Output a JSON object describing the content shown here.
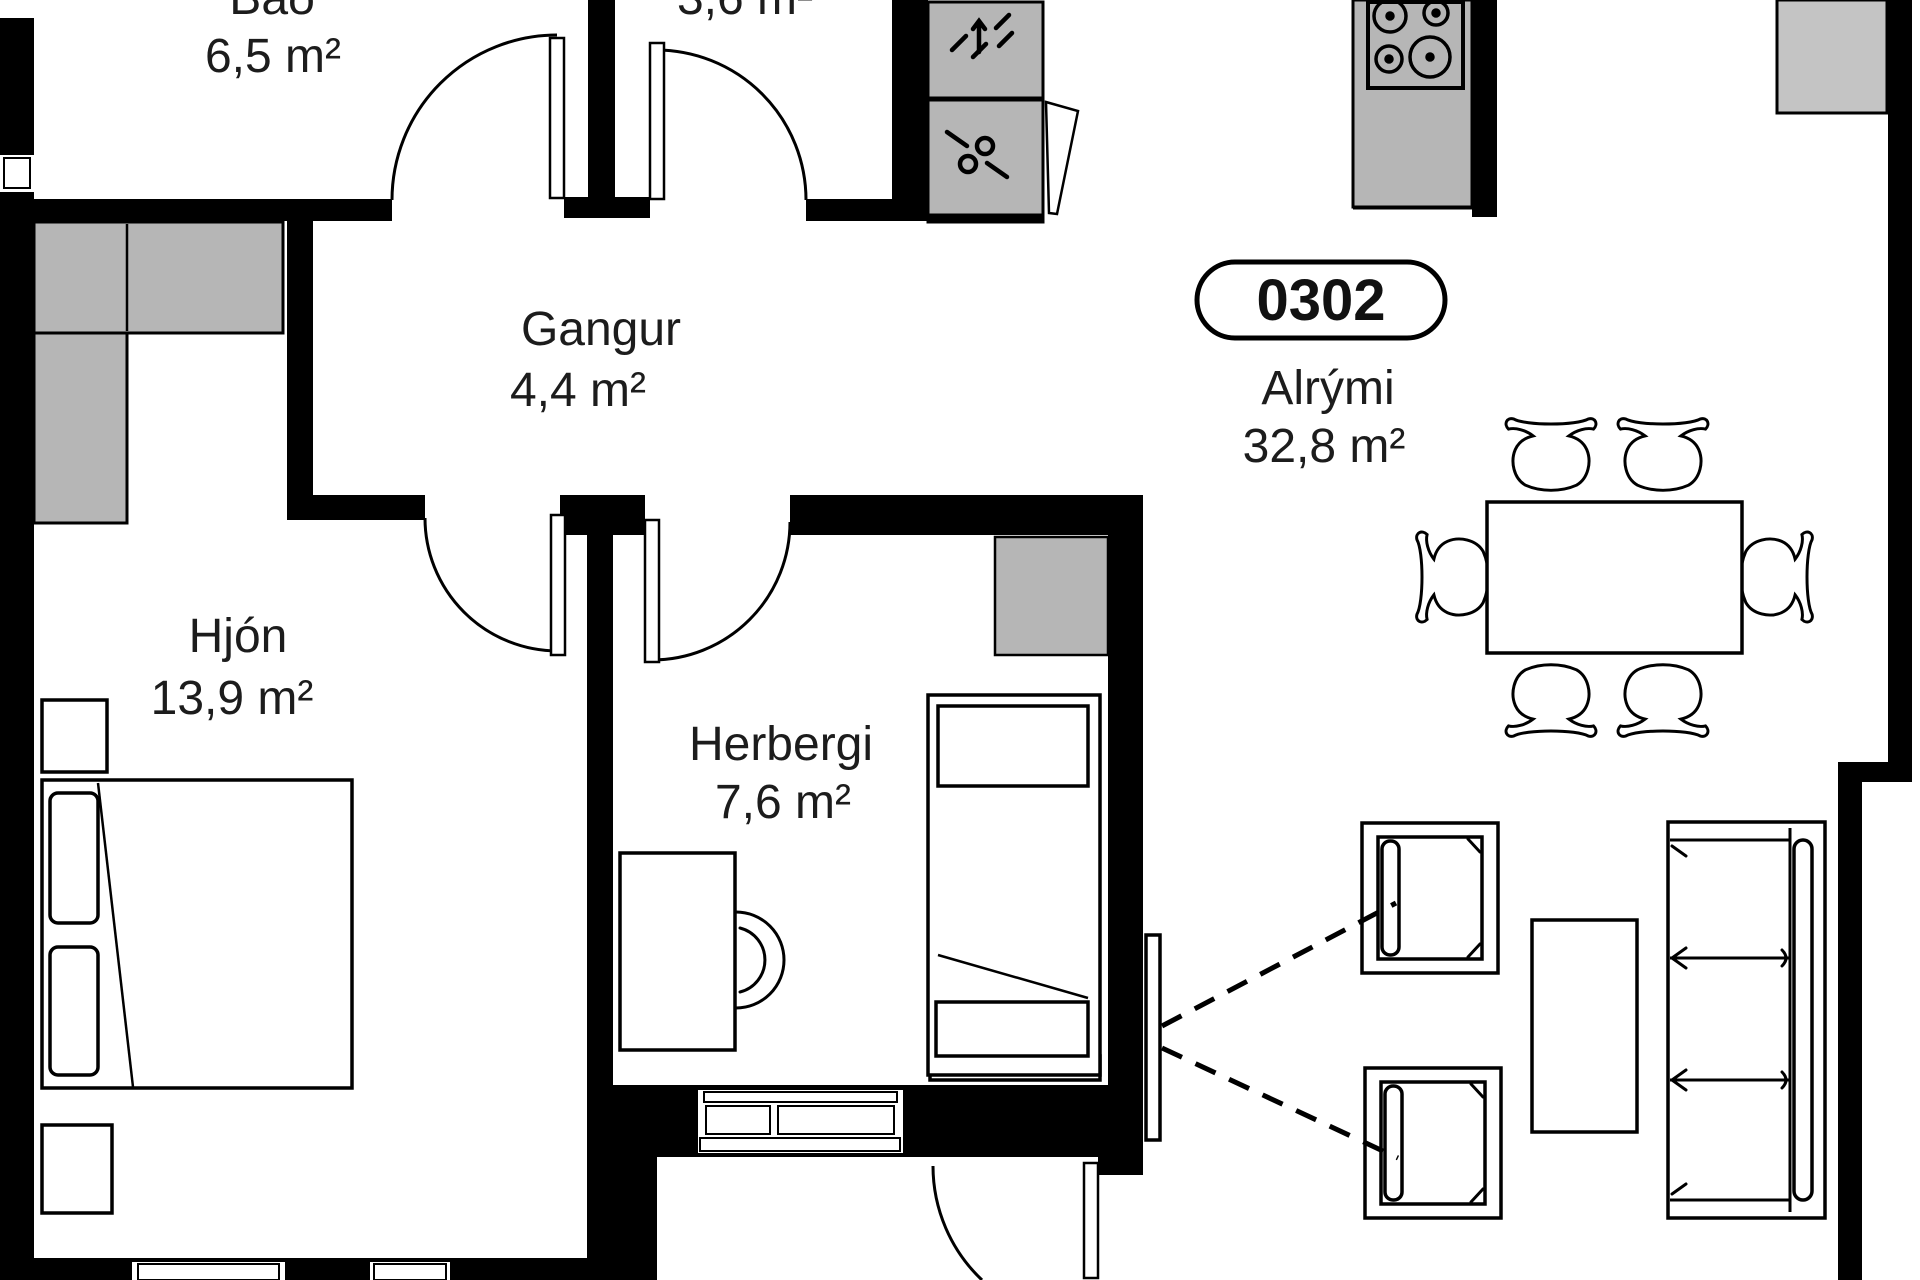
{
  "unit_badge": {
    "number": "0302"
  },
  "rooms": {
    "bathroom": {
      "name": "Bað",
      "area": "6,5 m²"
    },
    "storage": {
      "name": "",
      "area": "3,6 m²"
    },
    "hallway": {
      "name": "Gangur",
      "area": "4,4 m²"
    },
    "master_bedroom": {
      "name": "Hjón",
      "area": "13,9 m²"
    },
    "bedroom": {
      "name": "Herbergi",
      "area": "7,6 m²"
    },
    "living_room": {
      "name": "Alrými",
      "area": "32,8 m²"
    }
  },
  "colors": {
    "wall": "#000000",
    "fixture": "#b6b6b6",
    "fixture_light": "#c4c4c4",
    "line": "#000000",
    "text": "#1c1c1c",
    "background": "#ffffff"
  },
  "furniture_icons": [
    "double-bed",
    "pillow",
    "nightstand",
    "wardrobe",
    "desk",
    "desk-chair",
    "single-bed",
    "dryer",
    "washer",
    "cooktop",
    "kitchen-counter",
    "dining-table",
    "dining-chair",
    "armchair",
    "coffee-table",
    "sofa",
    "tv",
    "window",
    "door-swing",
    "balcony-door",
    "sightline"
  ]
}
